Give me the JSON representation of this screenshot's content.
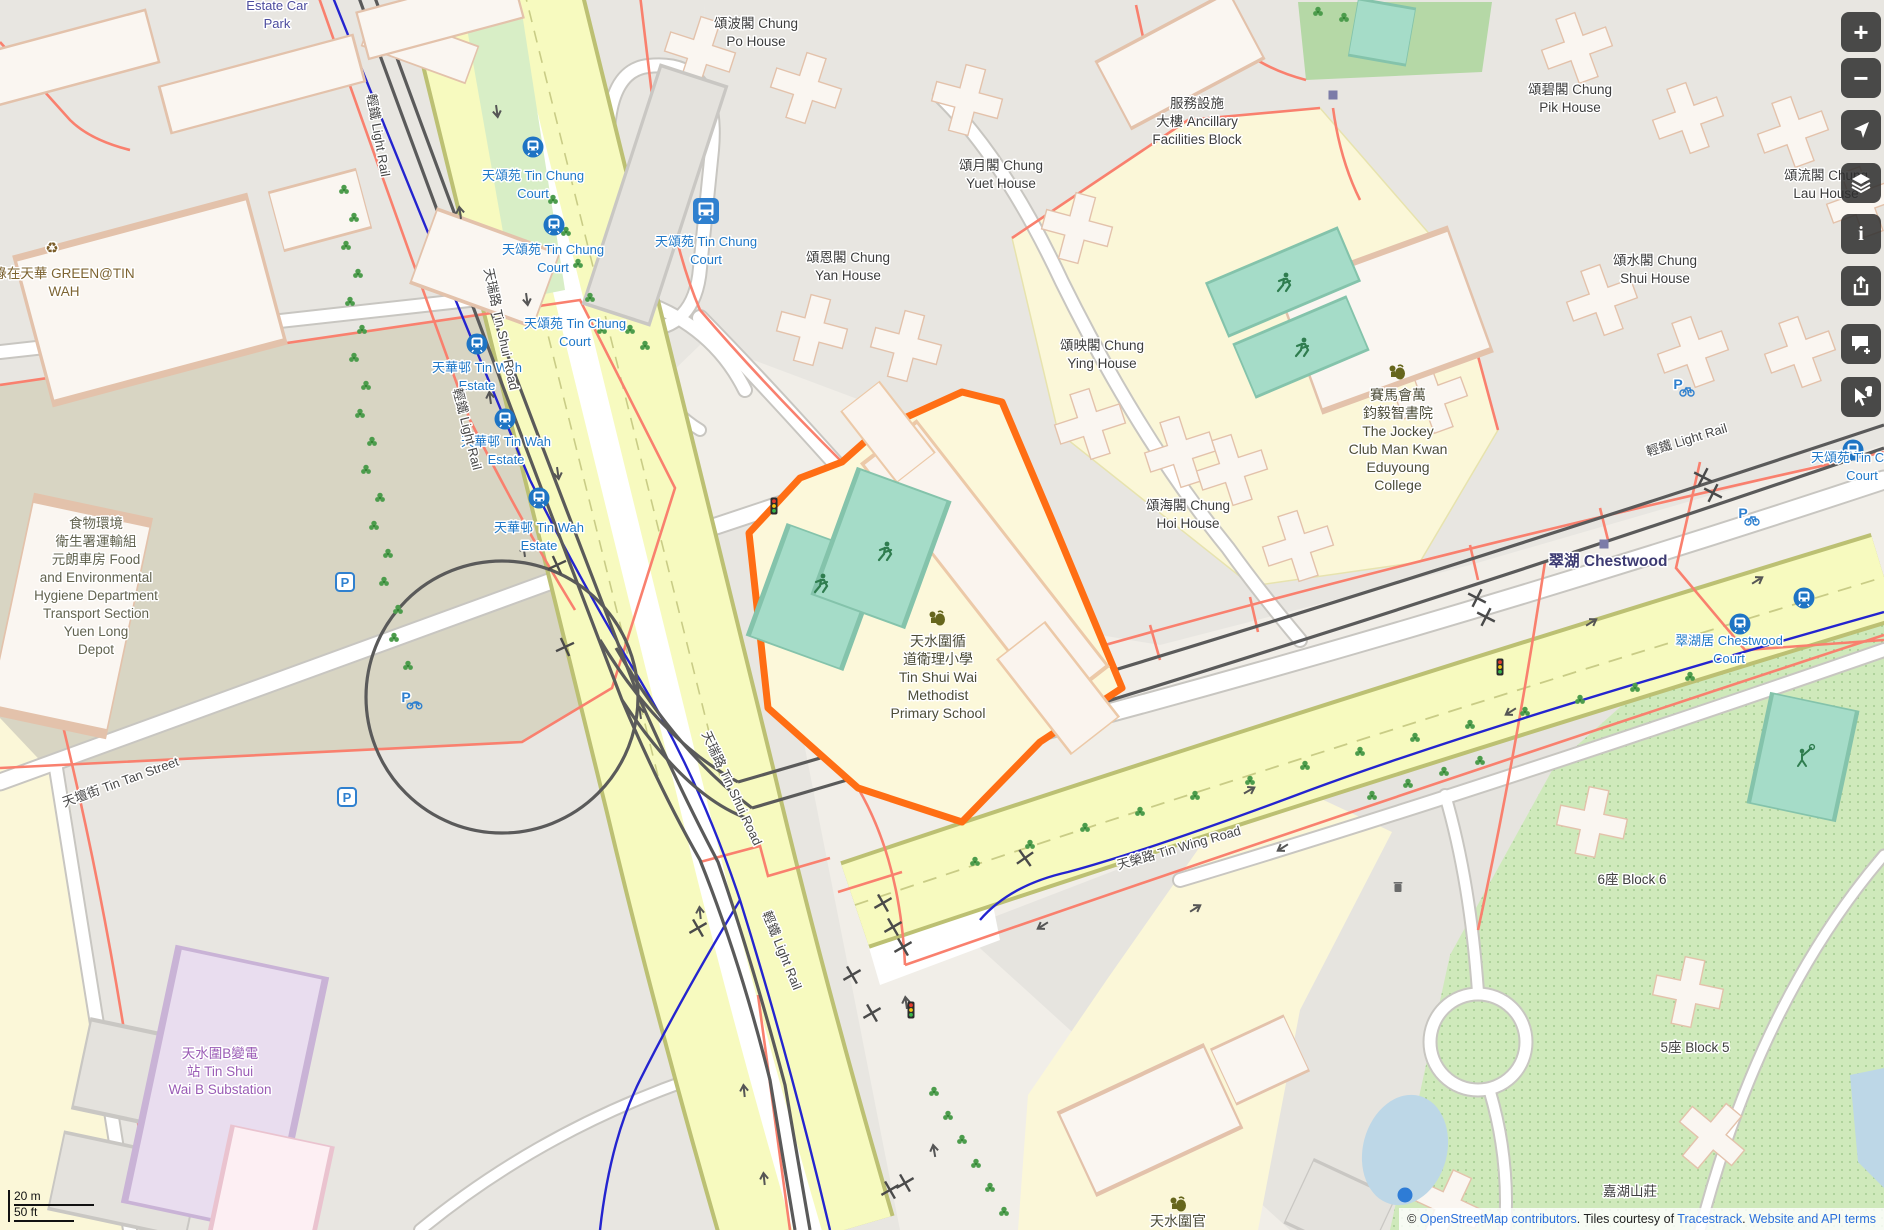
{
  "map": {
    "attribution": {
      "copyright_prefix": "© ",
      "link_osm": "OpenStreetMap contributors",
      "middle": ". Tiles courtesy of ",
      "link_tracestrack": "Tracestrack",
      "dot": ". ",
      "link_terms": "Website and API terms"
    },
    "scalebar": {
      "metric": "20 m",
      "imperial": "50 ft"
    },
    "controls": [
      {
        "name": "zoom-in",
        "glyph": "+"
      },
      {
        "name": "zoom-out",
        "glyph": "−"
      },
      {
        "name": "locate",
        "glyph": ""
      },
      {
        "name": "layers",
        "glyph": ""
      },
      {
        "name": "info",
        "glyph": "i"
      },
      {
        "name": "share",
        "glyph": ""
      },
      {
        "name": "add-note",
        "glyph": ""
      },
      {
        "name": "query-features",
        "glyph": ""
      }
    ],
    "colors": {
      "highlight_orange": "#ff6e14",
      "road_yellow": "#f7fabf",
      "pitch_teal": "#a5dcc8",
      "station_blue": "#1e74c4",
      "cycle_blue": "#2424cf",
      "path_salmon": "#f9806e"
    },
    "labels": [
      {
        "lines": [
          "頌波閣 Chung",
          "Po House"
        ],
        "x": 756,
        "y": 28,
        "cls": "b"
      },
      {
        "lines": [
          "頌碧閣 Chung",
          "Pik House"
        ],
        "x": 1570,
        "y": 94,
        "cls": "b"
      },
      {
        "lines": [
          "頌流閣 Chung",
          "Lau House"
        ],
        "x": 1826,
        "y": 180,
        "cls": "b"
      },
      {
        "lines": [
          "頌水閣 Chung",
          "Shui House"
        ],
        "x": 1655,
        "y": 265,
        "cls": "b"
      },
      {
        "lines": [
          "頌月閣 Chung",
          "Yuet House"
        ],
        "x": 1001,
        "y": 170,
        "cls": "b"
      },
      {
        "lines": [
          "頌恩閣 Chung",
          "Yan House"
        ],
        "x": 848,
        "y": 262,
        "cls": "b"
      },
      {
        "lines": [
          "頌映閣 Chung",
          "Ying House"
        ],
        "x": 1102,
        "y": 350,
        "cls": "b"
      },
      {
        "lines": [
          "頌海閣 Chung",
          "Hoi House"
        ],
        "x": 1188,
        "y": 510,
        "cls": "b"
      },
      {
        "lines": [
          "服務設施",
          "大樓 Ancillary",
          "Facilities Block"
        ],
        "x": 1197,
        "y": 108,
        "cls": "b"
      },
      {
        "lines": [
          "5座 Block 5"
        ],
        "x": 1695,
        "y": 1052,
        "cls": "b"
      },
      {
        "lines": [
          "6座 Block 6"
        ],
        "x": 1632,
        "y": 884,
        "cls": "b"
      },
      {
        "lines": [
          "嘉湖山莊"
        ],
        "x": 1630,
        "y": 1196,
        "cls": "b"
      },
      {
        "lines": [
          "Estate Car",
          "Park"
        ],
        "x": 277,
        "y": 10,
        "cls": "car"
      },
      {
        "lines": [
          "綠在天華 GREEN@TIN",
          "WAH"
        ],
        "x": 64,
        "y": 278,
        "cls": "a"
      },
      {
        "lines": [
          "食物環境",
          "衛生署運輸組",
          "元朗車房 Food",
          "and Environmental",
          "Hygiene Department",
          "Transport Section",
          "Yuen Long",
          "Depot"
        ],
        "x": 96,
        "y": 528,
        "cls": "d"
      },
      {
        "lines": [
          "天水圍B變電",
          "站 Tin Shui",
          "Wai B Substation"
        ],
        "x": 220,
        "y": 1058,
        "cls": "pw"
      },
      {
        "lines": [
          "天水圍循",
          "道衛理小學",
          "Tin Shui Wai",
          "Methodist",
          "Primary School"
        ],
        "x": 938,
        "y": 646,
        "cls": "sc"
      },
      {
        "lines": [
          "賽馬會萬",
          "鈞毅智書院",
          "The Jockey",
          "Club Man Kwan",
          "Eduyoung",
          "College"
        ],
        "x": 1398,
        "y": 400,
        "cls": "sc"
      },
      {
        "lines": [
          "天水圍官"
        ],
        "x": 1178,
        "y": 1226,
        "cls": "sc"
      },
      {
        "lines": [
          "天頌苑 Tin Chung",
          "Court"
        ],
        "x": 533,
        "y": 180,
        "cls": "s"
      },
      {
        "lines": [
          "天頌苑 Tin Chung",
          "Court"
        ],
        "x": 553,
        "y": 254,
        "cls": "s"
      },
      {
        "lines": [
          "天頌苑 Tin Chung",
          "Court"
        ],
        "x": 575,
        "y": 328,
        "cls": "s"
      },
      {
        "lines": [
          "天頌苑 Tin Chung",
          "Court"
        ],
        "x": 706,
        "y": 246,
        "cls": "s"
      },
      {
        "lines": [
          "天華邨 Tin Wah",
          "Estate"
        ],
        "x": 477,
        "y": 372,
        "cls": "s"
      },
      {
        "lines": [
          "天華邨 Tin Wah",
          "Estate"
        ],
        "x": 506,
        "y": 446,
        "cls": "s"
      },
      {
        "lines": [
          "天華邨 Tin Wah",
          "Estate"
        ],
        "x": 539,
        "y": 532,
        "cls": "s"
      },
      {
        "lines": [
          "天頌苑 Tin Chung",
          "Court"
        ],
        "x": 1862,
        "y": 462,
        "cls": "s"
      },
      {
        "lines": [
          "翠湖居 Chestwood",
          "Court"
        ],
        "x": 1729,
        "y": 645,
        "cls": "s"
      },
      {
        "lines": [
          "翠湖 Chestwood"
        ],
        "x": 1608,
        "y": 566,
        "cls": "p"
      },
      {
        "lines": [
          "天瑞路 Tin Shui Road"
        ],
        "x": 497,
        "y": 330,
        "cls": "r",
        "rot": 78
      },
      {
        "lines": [
          "天瑞路 Tin Shui Road"
        ],
        "x": 728,
        "y": 790,
        "cls": "r",
        "rot": 65
      },
      {
        "lines": [
          "天壇街 Tin Tan Street"
        ],
        "x": 122,
        "y": 786,
        "cls": "r",
        "rot": -20
      },
      {
        "lines": [
          "天榮路 Tin Wing Road"
        ],
        "x": 1180,
        "y": 852,
        "cls": "r",
        "rot": -16
      },
      {
        "lines": [
          "輕鐵 Light Rail"
        ],
        "x": 374,
        "y": 136,
        "cls": "r",
        "rot": 80
      },
      {
        "lines": [
          "輕鐵 Light Rail"
        ],
        "x": 463,
        "y": 430,
        "cls": "r",
        "rot": 76
      },
      {
        "lines": [
          "輕鐵 Light Rail"
        ],
        "x": 778,
        "y": 952,
        "cls": "r",
        "rot": 68
      },
      {
        "lines": [
          "輕鐵 Light Rail"
        ],
        "x": 1688,
        "y": 444,
        "cls": "r",
        "rot": -17
      }
    ],
    "icons": [
      {
        "type": "light-rail-stop",
        "x": 533,
        "y": 147
      },
      {
        "type": "light-rail-stop",
        "x": 554,
        "y": 225
      },
      {
        "type": "light-rail-stop",
        "x": 477,
        "y": 344
      },
      {
        "type": "light-rail-stop",
        "x": 505,
        "y": 419
      },
      {
        "type": "light-rail-stop",
        "x": 539,
        "y": 498
      },
      {
        "type": "light-rail-stop",
        "x": 1853,
        "y": 450
      },
      {
        "type": "light-rail-stop",
        "x": 1804,
        "y": 598
      },
      {
        "type": "light-rail-stop",
        "x": 1740,
        "y": 624
      },
      {
        "type": "bus-terminus",
        "x": 706,
        "y": 211
      },
      {
        "type": "school",
        "x": 937,
        "y": 618
      },
      {
        "type": "school",
        "x": 1397,
        "y": 372
      },
      {
        "type": "school",
        "x": 1178,
        "y": 1204
      },
      {
        "type": "parking",
        "x": 345,
        "y": 582
      },
      {
        "type": "parking",
        "x": 347,
        "y": 797
      },
      {
        "type": "bicycle-parking",
        "x": 1682,
        "y": 387
      },
      {
        "type": "bicycle-parking",
        "x": 1747,
        "y": 516
      },
      {
        "type": "motorcycle-parking",
        "x": 410,
        "y": 700
      },
      {
        "type": "traffic-light",
        "x": 774,
        "y": 506
      },
      {
        "type": "traffic-light",
        "x": 911,
        "y": 1010
      },
      {
        "type": "traffic-light",
        "x": 1500,
        "y": 667
      },
      {
        "type": "waste-basket",
        "x": 1398,
        "y": 887
      },
      {
        "type": "recycling",
        "x": 52,
        "y": 248
      },
      {
        "type": "location-dot",
        "x": 1405,
        "y": 1195
      },
      {
        "type": "small-square",
        "x": 1604,
        "y": 544
      },
      {
        "type": "small-square",
        "x": 1333,
        "y": 95
      },
      {
        "type": "runner",
        "x": 820,
        "y": 583
      },
      {
        "type": "runner",
        "x": 884,
        "y": 551
      },
      {
        "type": "runner",
        "x": 1283,
        "y": 282
      },
      {
        "type": "runner",
        "x": 1301,
        "y": 347
      },
      {
        "type": "badminton",
        "x": 1803,
        "y": 757
      }
    ],
    "lane_arrows": [
      [
        497,
        112,
        172
      ],
      [
        460,
        212,
        -8
      ],
      [
        527,
        300,
        172
      ],
      [
        490,
        397,
        -8
      ],
      [
        558,
        474,
        172
      ],
      [
        524,
        550,
        -8
      ],
      [
        640,
        712,
        -8
      ],
      [
        700,
        912,
        -6
      ],
      [
        744,
        1090,
        -6
      ],
      [
        764,
        1178,
        -6
      ],
      [
        906,
        1002,
        -8
      ],
      [
        934,
        1150,
        -10
      ],
      [
        1250,
        790,
        60
      ],
      [
        1592,
        622,
        58
      ],
      [
        1758,
        580,
        58
      ],
      [
        1510,
        712,
        238
      ],
      [
        1282,
        848,
        238
      ],
      [
        1042,
        926,
        238
      ],
      [
        1196,
        908,
        58
      ],
      [
        1690,
        642,
        238
      ]
    ],
    "crossings": [
      [
        557,
        565,
        20
      ],
      [
        565,
        647,
        20
      ],
      [
        698,
        928,
        15
      ],
      [
        883,
        903,
        15
      ],
      [
        893,
        927,
        15
      ],
      [
        903,
        947,
        15
      ],
      [
        852,
        975,
        15
      ],
      [
        872,
        1013,
        15
      ],
      [
        1025,
        858,
        10
      ],
      [
        890,
        1190,
        15
      ],
      [
        905,
        1183,
        15
      ],
      [
        1477,
        598,
        -18
      ],
      [
        1486,
        617,
        -18
      ],
      [
        1703,
        477,
        -18
      ],
      [
        1713,
        493,
        -18
      ]
    ],
    "trees": [
      [
        344,
        190
      ],
      [
        354,
        218
      ],
      [
        346,
        246
      ],
      [
        358,
        274
      ],
      [
        350,
        302
      ],
      [
        362,
        330
      ],
      [
        354,
        358
      ],
      [
        366,
        386
      ],
      [
        360,
        414
      ],
      [
        372,
        442
      ],
      [
        366,
        470
      ],
      [
        380,
        498
      ],
      [
        374,
        526
      ],
      [
        388,
        554
      ],
      [
        384,
        582
      ],
      [
        398,
        610
      ],
      [
        394,
        638
      ],
      [
        408,
        666
      ],
      [
        553,
        200
      ],
      [
        566,
        232
      ],
      [
        578,
        264
      ],
      [
        590,
        298
      ],
      [
        602,
        330
      ],
      [
        630,
        330
      ],
      [
        645,
        346
      ],
      [
        934,
        1092
      ],
      [
        948,
        1116
      ],
      [
        962,
        1140
      ],
      [
        976,
        1164
      ],
      [
        990,
        1188
      ],
      [
        1004,
        1212
      ],
      [
        975,
        862
      ],
      [
        1030,
        845
      ],
      [
        1085,
        828
      ],
      [
        1140,
        812
      ],
      [
        1195,
        796
      ],
      [
        1250,
        781
      ],
      [
        1305,
        766
      ],
      [
        1360,
        752
      ],
      [
        1415,
        738
      ],
      [
        1470,
        725
      ],
      [
        1525,
        712
      ],
      [
        1580,
        700
      ],
      [
        1635,
        688
      ],
      [
        1690,
        677
      ],
      [
        1372,
        796
      ],
      [
        1408,
        784
      ],
      [
        1444,
        772
      ],
      [
        1480,
        761
      ],
      [
        1318,
        12
      ],
      [
        1344,
        18
      ]
    ]
  }
}
